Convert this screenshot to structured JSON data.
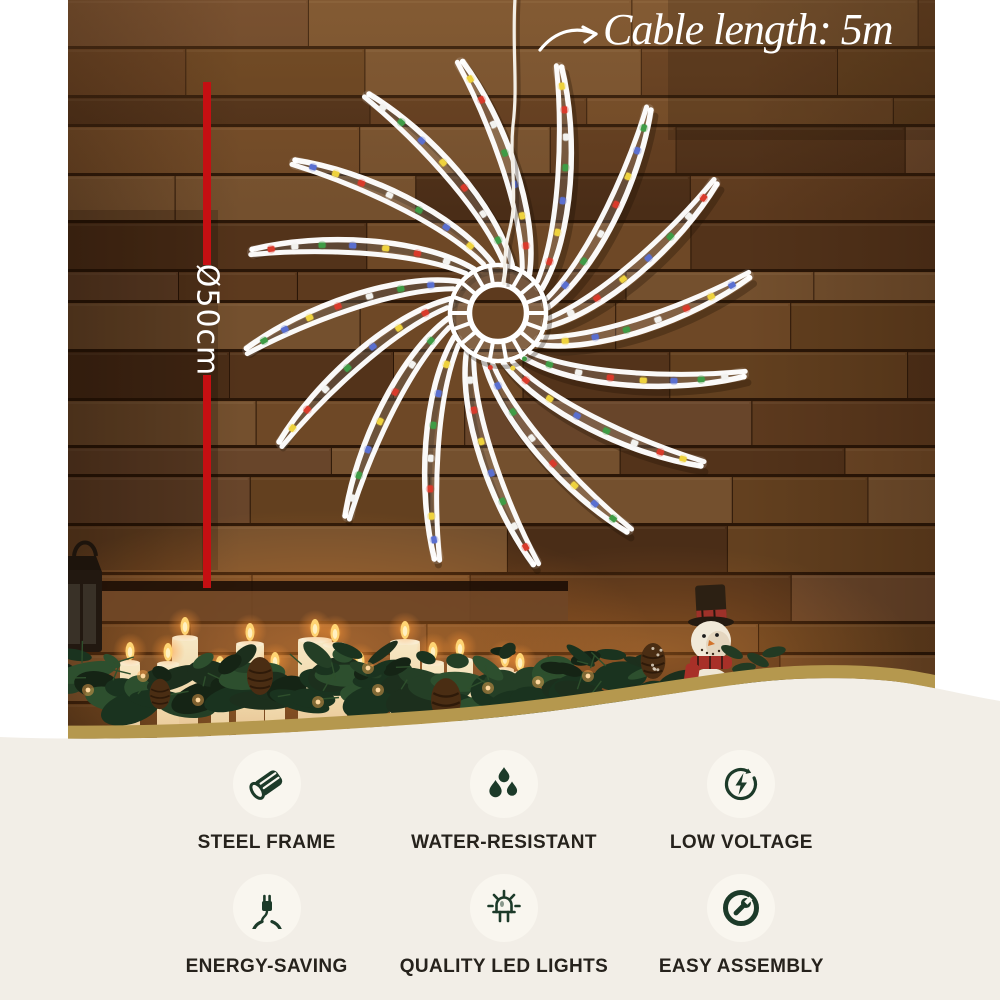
{
  "annotations": {
    "cable_note": "Cable length: 5m",
    "diameter_label": "Ø50cm"
  },
  "features": {
    "items": [
      {
        "icon": "steel-frame-icon",
        "label": "STEEL FRAME"
      },
      {
        "icon": "water-resistant-icon",
        "label": "WATER-RESISTANT"
      },
      {
        "icon": "low-voltage-icon",
        "label": "LOW VOLTAGE"
      },
      {
        "icon": "energy-saving-icon",
        "label": "ENERGY-SAVING"
      },
      {
        "icon": "quality-led-lights-icon",
        "label": "QUALITY LED LIGHTS"
      },
      {
        "icon": "easy-assembly-icon",
        "label": "EASY ASSEMBLY"
      }
    ]
  },
  "ornament": {
    "arm_count": 16,
    "led_colors": [
      "#d93a2b",
      "#eed23e",
      "#5a6fd0",
      "#3f9c46",
      "#f2f2ef"
    ]
  },
  "colors": {
    "dimension_red": "#c50f12",
    "wave_gold": "#b5984e",
    "section_cream": "#f2eee7",
    "icon_green": "#1c3a29",
    "label_text": "#26221c",
    "annotation_white": "#ffffff"
  }
}
